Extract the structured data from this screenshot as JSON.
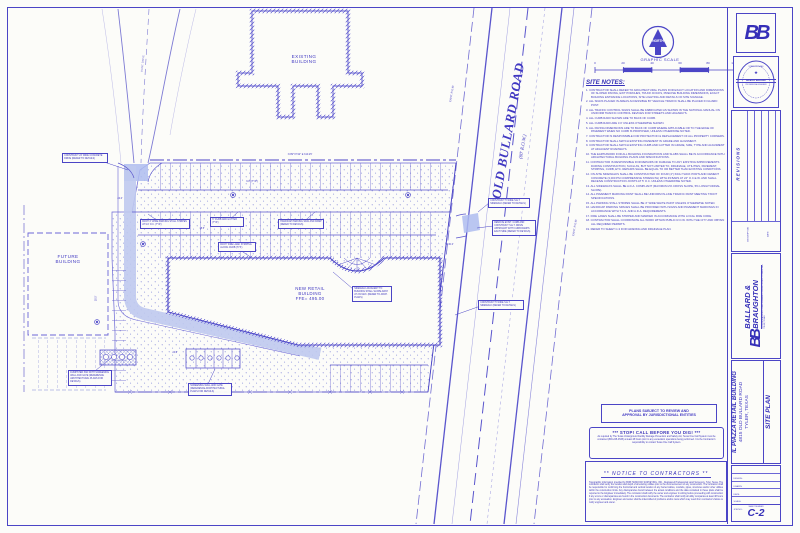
{
  "colors": {
    "ink": "#4b45c6",
    "ink_strong": "#352fb8",
    "highlight": "#bfc9ee",
    "paper": "#fcfcf9"
  },
  "drawing": {
    "existing_building": "EXISTING\nBUILDING",
    "future_building": "FUTURE\nBUILDING",
    "new_building": "NEW RETAIL\nBUILDING\nFFE= 495.00",
    "road_name": "OLD BULLARD ROAD",
    "road_row": "(80' R.O.W.)",
    "row_label_1": "EXIST. R.O.W.",
    "row_label_2": "EXIST. R.O.W.",
    "exist_drive": "EXIST. DRIVE"
  },
  "north": {
    "label": "NORTH"
  },
  "scale": {
    "title": "GRAPHIC SCALE",
    "ticks": [
      "0",
      "20",
      "40",
      "60",
      "80",
      "100 FEET"
    ]
  },
  "site_notes": {
    "title": "SITE NOTES:",
    "items": [
      "1.  CONTRACTOR SHALL REFER TO ARCHITECTURAL PLANS FOR EXACT LOCATION AND DIMENSIONS OF SLOPED PAVING, EXIT PORCHES, TRUCK DOCKS, PRECISE BUILDING DIMENSIONS, EXACT BUILDING ENTRANCE LOCATIONS, SITE LIGHTING AND DETAILS OF SITE SIGNAGE.",
      "2.  ALL SIGNS PLACED IN AREAS ACCESSIBLE BY VEHICLE TRAFFIC SHALL BE PLACED IN GUARD POST.",
      "3.  ALL TRAFFIC CONTROL SIGNS SHALL BE FABRICATED AS SHOWN IN THE NATIONAL MANUAL ON UNIFORM TRAFFIC CONTROL DEVICES FOR STREETS AND HIGHWAYS.",
      "4.  ALL CURB RADII SHOWN ARE TO BACK OF CURB.",
      "5.  ALL CURB RADII ARE 3.0' UNLESS OTHERWISE SHOWN.",
      "6.  ALL PAVING DIMENSIONS ARE TO BACK OF CURB WHERE APPLICABLE OR TO THE EDGE OF PAVEMENT WHEN NO CURB IS PROPOSED, UNLESS OTHERWISE NOTED.",
      "7.  CONTRACTOR IS RESPONSIBLE FOR PROTECTION & REPLACEMENT OF ALL PROPERTY CORNERS.",
      "8.  CONTRACTOR SHALL MATCH EXISTING PAVEMENT IN GRADE AND ALIGNMENT.",
      "9.  CONTRACTOR SHALL MATCH EXISTING CURB AND GUTTER IN GRADE, SIZE, TYPE AND ALIGNMENT AT ADJACENT ROADWAYS.",
      "10. THE EARTHWORK FOR ALL BUILDING FOUNDATIONS AND SLABS SHALL BE IN ACCORDANCE WITH ARCHITECTURAL BUILDING PLANS AND SPECIFICATIONS.",
      "11. CONTRACTOR IS RESPONSIBLE FOR REPAIRS OF DAMAGE TO ANY EXISTING IMPROVEMENTS DURING CONSTRUCTION, SUCH AS, BUT NOT LIMITED TO, DRAINAGE, UTILITIES, PAVEMENT, STRIPING, CURB, ETC. REPAIRS SHALL BE EQUAL TO OR BETTER THAN EXISTING CONDITIONS.",
      "12. ON-SITE SIDEWALKS SHALL BE CONSTRUCTED OF FOUR (4\") INCH THICK PORTLAND CEMENT CONCRETE (3,000 PSI COMPRESSIVE STRENGTH) WITH #3 BARS AT 24\" O.C.E.W. AND SHALL RECEIVE CONSTRUCTION JOINTS AT 5' O.C. UNLESS OTHERWISE NOTED.",
      "13. ALL SIDEWALKS SHALL BE A.D.A. COMPLIANT (MAXIMUM 2% CROSS SLOPE, 5% LONGITUDINAL SLOPE).",
      "14. ALL PAVEMENT MARKING PAINT SHALL BE UNIFORM IN-LINE TRAFFIC PAINT MEETING TXDOT SPECIFICATIONS.",
      "15. ALL PARKING STALL STRIPES SHALL BE 4\" WIDE WHITE PAINT UNLESS OTHERWISE NOTED.",
      "16. HANDICAP PARKING SPACES SHALL BE PROVIDED WITH SIGNS AND PAVEMENT MARKINGS IN ACCORDANCE WITH T.A.S. AND A.D.A. REQUIREMENTS.",
      "17. FIRE LANES SHALL BE STRIPED AND MARKED IN ACCORDANCE WITH LOCAL FIRE CODE.",
      "18. CONTRACTOR SHALL COORDINATE ALL WORK WITHIN PUBLIC R.O.W. WITH THE CITY AND OBTAIN ALL REQUIRED PERMITS.",
      "19. REFER TO SHEET C-3 FOR GRADING AND DRAINAGE PLAN."
    ]
  },
  "callouts": [
    "CONSTRUCT 24' WIDE CONCRETE DRIVE (REFER TO DETAILS)",
    "PAINT 4\" WIDE PARKING STALL STRIPES AT 9.0' O.C. (TYP.)",
    "6\" CURB AND GUTTER (TYP.)",
    "HANDICAP PARKING SIGN AND RAMP (REFER TO DETAILS)",
    "CONSTRUCT 5' WIDE S.E.T. SIDEWALK (REFER TO DETAILS)",
    "REMOVE EXIST. CURB AND CONSTRUCT S.E.T. DRIVE APPROACH WITH CURB RAMPS EACH SIDE (REFER TO DETAILS)",
    "CONSTRUCT 5' WIDE S.E.T. SIDEWALK (REFER TO DETAILS)",
    "SIDEWALK ADJACENT TO BUILDING SHALL SLOPE AWAY AT 2% MAX. (REFER TO ARCH. PLANS)",
    "DUMPSTER PAD WITH SCREENING WALL AND GATE (REFERENCE ARCHITECTURAL PLANS FOR DETAILS)",
    "SCREENING WALL AND GATE (REFERENCE ARCHITECTURAL PLANS FOR DETAILS)",
    "PAINT 'FIRE LANE' STRIPING ALONG CURB (TYP.)"
  ],
  "dims": [
    "24.0'",
    "18.5'",
    "9.0' (TYP.)",
    "R30.0'",
    "24.0'",
    "18.5'",
    "N 89°37'42\" E   310.25'"
  ],
  "notices": {
    "approval": "PLANS SUBJECT TO REVIEW AND\nAPPROVAL BY JURISDICTIONAL ENTITIES",
    "stop_title": "***   STOP!  CALL BEFORE YOU DIG!   ***",
    "stop_body": "As required by The Texas Underground Facility Damage Prevention and Safety Act, Texas One Call System must be contacted (800-245-4545) at least 48 hours prior to any excavation operations being performed. It is the Contractor's responsibility to contact Texas One Call System.",
    "contractors_title": "**    NOTICE  TO  CONTRACTORS    **",
    "contractors_body": "Topographic information provided by BOB HANCOCK SURVEYING, INC., Registered Professional Land Surveyors, Tyler, Texas. The contractor shall verify the location and depth of all existing utilities prior to the commencement of any construction. The contractor shall be responsible for confirming the horizontal and vertical location of any buried cables, conduits, pipes, structures and/or other utilities within the construction limits. Any discrepancies found between the actual conditions and the data contained in these plans shall be reported to the Engineer immediately. The contractor shall notify the owner and engineer in writing before proceeding with construction if any errors or discrepancies are found in the construction documents. The contractor shall notify all utility companies at least 48 hours prior to any excavation. Engineer and owner shall be indemnified of problems and/or costs which may result from contractor's failure to notify engineer and owner."
  },
  "titleblock": {
    "logo": "BB",
    "seal": {
      "state": "STATE OF TEXAS",
      "star": "★",
      "name": "BRIAN A. BALLARD",
      "title": "PROFESSIONAL ENGINEER"
    },
    "revisions": {
      "title": "REVISIONS",
      "col_description": "DESCRIPTION",
      "col_date": "DATE"
    },
    "firm": {
      "logo": "BB",
      "name_line1": "BALLARD &",
      "name_line2": "BRAUGHTON",
      "tagline": "CIVIL ENGINEERING • LAND PLANNING • DEVELOPMENT CONSULTING",
      "address": "TYLER, TEXAS"
    },
    "project": {
      "name": "IL PIAZZA RETAIL BUILDING",
      "address": "4815 OLD BULLARD ROAD",
      "city": "TYLER, TEXAS",
      "sheet_title": "SITE PLAN"
    },
    "fields": [
      "DESIGN:",
      "DRAWN:",
      "DATE:",
      "SCALE:",
      "JOB NO.:"
    ],
    "sheet_label": "SHEET NUMBER",
    "sheet_number": "C-2"
  }
}
